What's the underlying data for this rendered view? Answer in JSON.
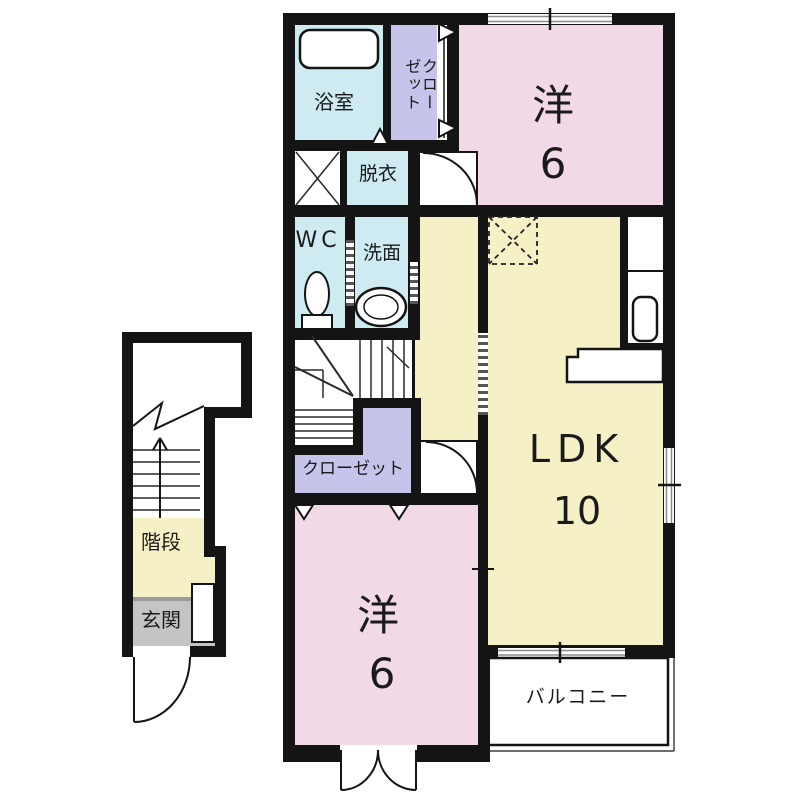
{
  "floor_plan": {
    "second_floor": {
      "bathroom_label": "浴室",
      "closet_top_line1": "クロー",
      "closet_top_line2": "ゼット",
      "western_room_top_label": "洋",
      "western_room_top_size": "6",
      "dressing_label": "脱衣",
      "wc_label": "WC",
      "washroom_label": "洗面",
      "closet_label": "クローゼット",
      "ldk_label": "LDK",
      "ldk_size": "10",
      "western_room_bottom_label": "洋",
      "western_room_bottom_size": "6",
      "balcony_label": "バルコニー"
    },
    "first_floor": {
      "stairs_label": "階段",
      "entrance_label": "玄関"
    },
    "colors": {
      "room_pink": "#F2D9E7",
      "room_yellow": "#F6F0C6",
      "room_cyan": "#CEEBF2",
      "closet_purple": "#C6C4EA",
      "entrance_gray": "#C4C4C4",
      "wall_black": "#141414"
    }
  }
}
